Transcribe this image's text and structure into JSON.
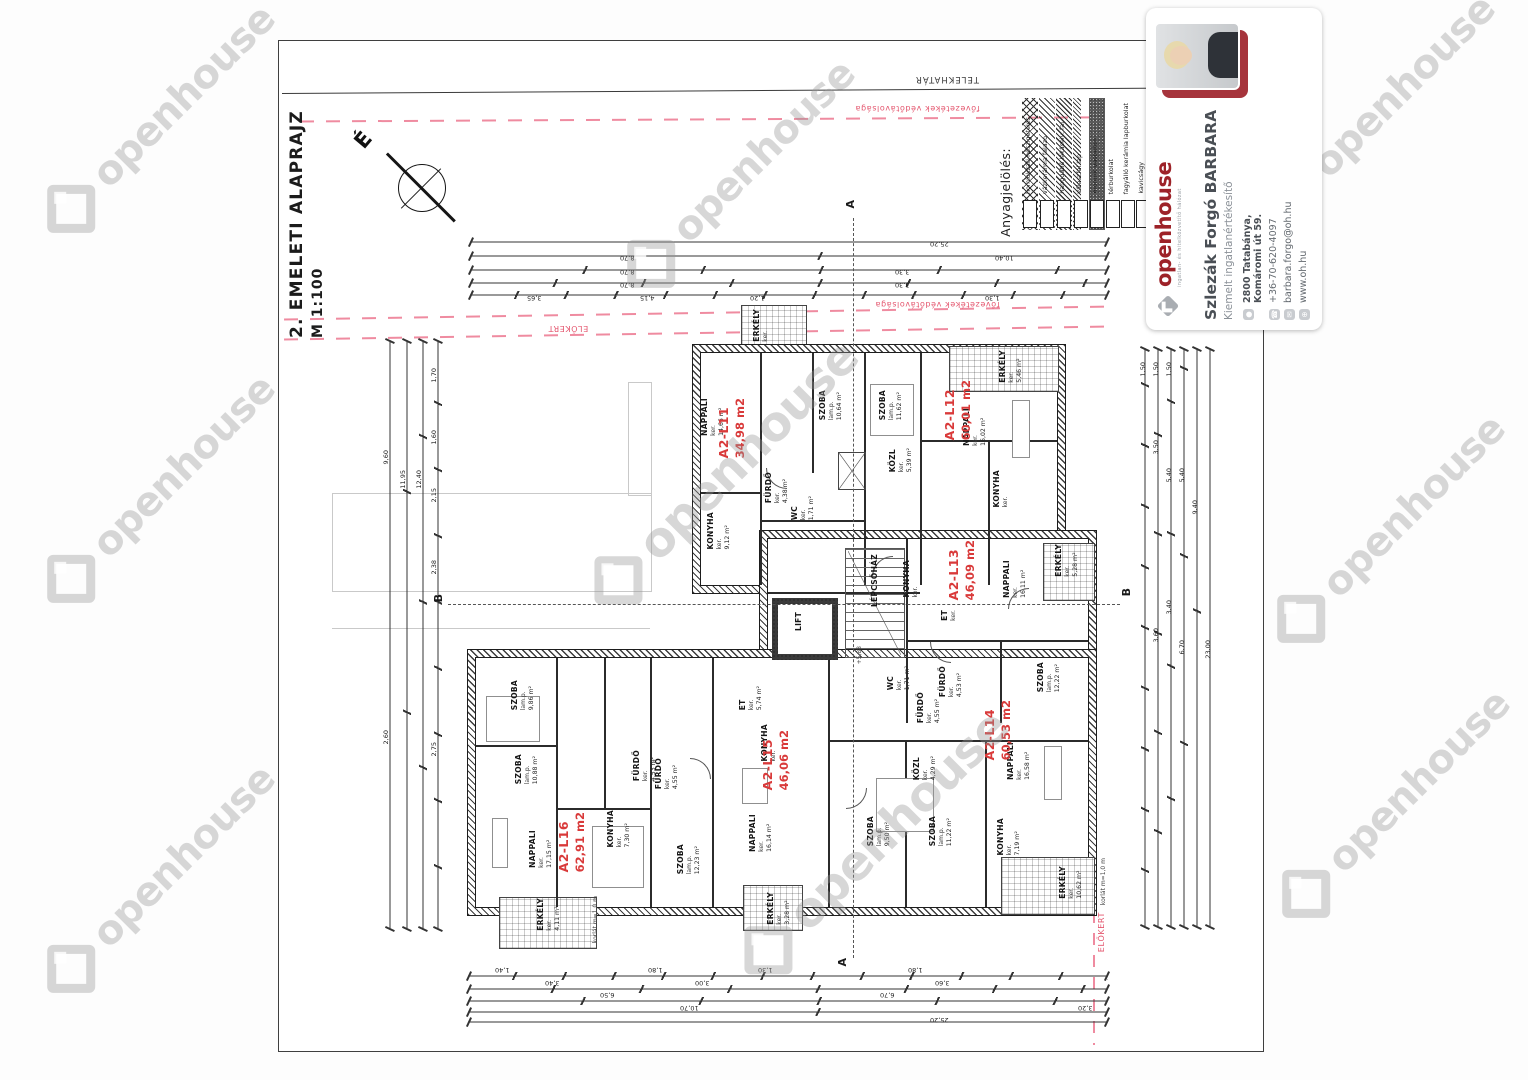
{
  "page": {
    "title": "2. EMELETI ALAPRAJZ",
    "scale": "M 1:100",
    "north": "É",
    "boundary": {
      "telekhatar": "TELEKHATÁR",
      "vedotav_top": "fővezetékek védőtávolsága",
      "vedotav_mid": "fővezetékek védőtávolsága",
      "elokert_top": "ELŐKERT",
      "elokert_right": "ELŐKERT"
    }
  },
  "legend": {
    "heading": "Anyagjelölés:",
    "items": [
      {
        "label": "homlokzati hőszigetelés",
        "cls": "sw-xhatch",
        "pos": "left:1022px"
      },
      {
        "label": "vázkerámia falazó",
        "cls": "sw-diag",
        "pos": "left:1039px"
      },
      {
        "label": "hanggátló lakáselv. fal",
        "cls": "sw-diag2",
        "pos": "left:1056px"
      },
      {
        "label": "válaszfal lap",
        "cls": "sw-thin",
        "pos": "left:1073px"
      },
      {
        "label": "monolit vasbeton",
        "cls": "sw-speckle",
        "pos": "left:1089px"
      },
      {
        "label": "térburkolat",
        "cls": "sw-empty",
        "pos": "left:1105px"
      },
      {
        "label": "fagyálló kerámia lapburkolat",
        "cls": "sw-empty",
        "pos": "left:1120px"
      },
      {
        "label": "kavicságy",
        "cls": "sw-empty",
        "pos": "left:1135px"
      }
    ]
  },
  "plan": {
    "apartments": [
      {
        "id": "A2-L11",
        "area": "34,98 m2",
        "pos": "left:716px;top:398px"
      },
      {
        "id": "A2-L12",
        "area": "60,01 m2",
        "pos": "left:942px;top:380px"
      },
      {
        "id": "A2-L13",
        "area": "46,09 m2",
        "pos": "left:946px;top:540px"
      },
      {
        "id": "A2-L14",
        "area": "60,53 m2",
        "pos": "left:982px;top:700px"
      },
      {
        "id": "A2-L15",
        "area": "46,06 m2",
        "pos": "left:760px;top:730px"
      },
      {
        "id": "A2-L16",
        "area": "62,91 m2",
        "pos": "left:556px;top:812px"
      }
    ],
    "rooms": [
      {
        "n": "NAPPALI",
        "s": "ker.",
        "a": "14,66 m²",
        "pos": "left:700px;top:398px"
      },
      {
        "n": "SZOBA",
        "s": "lam.p.",
        "a": "10,64 m²",
        "pos": "left:818px;top:390px"
      },
      {
        "n": "SZOBA",
        "s": "lam.p.",
        "a": "11,62 m²",
        "pos": "left:878px;top:390px"
      },
      {
        "n": "KONYHA",
        "s": "ker.",
        "a": "9,12 m²",
        "pos": "left:706px;top:512px"
      },
      {
        "n": "FÜRDŐ",
        "s": "ker.",
        "a": "4,38 m²",
        "pos": "left:764px;top:472px"
      },
      {
        "n": "WC",
        "s": "ker.",
        "a": "1,71 m²",
        "pos": "left:790px;top:496px"
      },
      {
        "n": "KÖZL",
        "s": "ker.",
        "a": "5,39 m²",
        "pos": "left:888px;top:448px"
      },
      {
        "n": "NAPPALI",
        "s": "ker.",
        "a": "16,02 m²",
        "pos": "left:962px;top:408px"
      },
      {
        "n": "KONYHA",
        "s": "ker.",
        "a": "",
        "pos": "left:992px;top:470px"
      },
      {
        "n": "ERKÉLY",
        "s": "ker.",
        "a": "5,46 m²",
        "pos": "left:998px;top:350px"
      },
      {
        "n": "ERKÉLY",
        "s": "ker.",
        "a": "",
        "pos": "left:752px;top:309px"
      },
      {
        "n": "KONYHA",
        "s": "ker.",
        "a": "",
        "pos": "left:902px;top:560px"
      },
      {
        "n": "NAPPALI",
        "s": "ker.",
        "a": "16,11 m²",
        "pos": "left:1002px;top:560px"
      },
      {
        "n": "SZOBA",
        "s": "lam.p.",
        "a": "12,22 m²",
        "pos": "left:1036px;top:662px"
      },
      {
        "n": "FÜRDŐ",
        "s": "ker.",
        "a": "4,53 m²",
        "pos": "left:938px;top:666px"
      },
      {
        "n": "ERKÉLY",
        "s": "ker.",
        "a": "5,28 m²",
        "pos": "left:1054px;top:544px"
      },
      {
        "n": "ET",
        "s": "ker.",
        "a": "",
        "pos": "left:940px;top:610px"
      },
      {
        "n": "NAPPALI",
        "s": "ker.",
        "a": "16,58 m²",
        "pos": "left:1006px;top:742px"
      },
      {
        "n": "SZOBA",
        "s": "lam.p.",
        "a": "11,22 m²",
        "pos": "left:928px;top:816px"
      },
      {
        "n": "SZOBA",
        "s": "lam.p.",
        "a": "9,50 m²",
        "pos": "left:866px;top:816px"
      },
      {
        "n": "KONYHA",
        "s": "ker.",
        "a": "7,19 m²",
        "pos": "left:996px;top:818px"
      },
      {
        "n": "FÜRDŐ",
        "s": "ker.",
        "a": "4,55 m²",
        "pos": "left:916px;top:692px"
      },
      {
        "n": "WC",
        "s": "ker.",
        "a": "1,71 m²",
        "pos": "left:886px;top:666px"
      },
      {
        "n": "KÖZL",
        "s": "ker.",
        "a": "4,29 m²",
        "pos": "left:912px;top:756px"
      },
      {
        "n": "ERKÉLY",
        "s": "ker.",
        "a": "10,62 m²",
        "pos": "left:1058px;top:866px"
      },
      {
        "n": "NAPPALI",
        "s": "ker.",
        "a": "16,14 m²",
        "pos": "left:748px;top:814px"
      },
      {
        "n": "SZOBA",
        "s": "lam.p.",
        "a": "12,23 m²",
        "pos": "left:676px;top:844px"
      },
      {
        "n": "KONYHA",
        "s": "ker.",
        "a": "",
        "pos": "left:760px;top:724px"
      },
      {
        "n": "FÜRDŐ",
        "s": "ker.",
        "a": "4,55 m²",
        "pos": "left:654px;top:758px"
      },
      {
        "n": "ET",
        "s": "ker.",
        "a": "5,74 m²",
        "pos": "left:738px;top:686px"
      },
      {
        "n": "ERKÉLY",
        "s": "ker.",
        "a": "3,28 m²",
        "pos": "left:766px;top:892px"
      },
      {
        "n": "NAPPALI",
        "s": "ker.",
        "a": "17,15 m²",
        "pos": "left:528px;top:830px"
      },
      {
        "n": "SZOBA",
        "s": "lam.p.",
        "a": "9,86 m²",
        "pos": "left:510px;top:680px"
      },
      {
        "n": "SZOBA",
        "s": "lam.p.",
        "a": "10,88 m²",
        "pos": "left:514px;top:754px"
      },
      {
        "n": "KONYHA",
        "s": "ker.",
        "a": "7,30 m²",
        "pos": "left:606px;top:810px"
      },
      {
        "n": "FÜRDŐ",
        "s": "ker.",
        "a": "4,53 m²",
        "pos": "left:632px;top:750px"
      },
      {
        "n": "ERKÉLY",
        "s": "ker.",
        "a": "4,11 m²",
        "pos": "left:536px;top:898px"
      },
      {
        "n": "LIFT",
        "s": "",
        "a": "",
        "pos": "left:794px;top:612px"
      },
      {
        "n": "LÉPCSŐHÁZ",
        "s": "",
        "a": "",
        "pos": "left:870px;top:554px"
      }
    ],
    "sections": [
      {
        "t": "A",
        "pos": "left:844px;top:200px"
      },
      {
        "t": "A",
        "pos": "left:836px;top:958px"
      },
      {
        "t": "B",
        "pos": "left:432px;top:594px"
      },
      {
        "t": "B",
        "pos": "left:1120px;top:588px"
      }
    ],
    "notes": [
      {
        "t": "korlát m=1,0 m",
        "pos": "left:592px;top:896px"
      },
      {
        "t": "korlát m=1,0 m",
        "pos": "left:1100px;top:858px"
      },
      {
        "t": "+5,88",
        "pos": "left:856px;top:646px"
      }
    ]
  },
  "dimensions": {
    "numbers": [
      {
        "t": "25,20",
        "cls": "r180",
        "pos": "left:930px;top:240px"
      },
      {
        "t": "10,40",
        "cls": "r180",
        "pos": "left:995px;top:254px"
      },
      {
        "t": "8,70",
        "cls": "r180",
        "pos": "left:620px;top:254px"
      },
      {
        "t": "8,70",
        "cls": "r180",
        "pos": "left:620px;top:268px"
      },
      {
        "t": "3,30",
        "cls": "r180",
        "pos": "left:895px;top:268px"
      },
      {
        "t": "8,70",
        "cls": "r180",
        "pos": "left:620px;top:281px"
      },
      {
        "t": "3,30",
        "cls": "r180",
        "pos": "left:895px;top:281px"
      },
      {
        "t": "4,15",
        "cls": "r180",
        "pos": "left:640px;top:294px"
      },
      {
        "t": "3,65",
        "cls": "r180",
        "pos": "left:527px;top:294px"
      },
      {
        "t": "1,20",
        "cls": "r180",
        "pos": "left:750px;top:294px"
      },
      {
        "t": "1,30",
        "cls": "r180",
        "pos": "left:985px;top:294px"
      },
      {
        "t": "25,20",
        "cls": "r180",
        "pos": "left:930px;top:1016px"
      },
      {
        "t": "10,70",
        "cls": "r180",
        "pos": "left:680px;top:1004px"
      },
      {
        "t": "6,50",
        "cls": "r180",
        "pos": "left:600px;top:991px"
      },
      {
        "t": "6,70",
        "cls": "r180",
        "pos": "left:880px;top:991px"
      },
      {
        "t": "3,40",
        "cls": "r180",
        "pos": "left:545px;top:979px"
      },
      {
        "t": "3,00",
        "cls": "r180",
        "pos": "left:695px;top:979px"
      },
      {
        "t": "3,60",
        "cls": "r180",
        "pos": "left:935px;top:979px"
      },
      {
        "t": "1,40",
        "cls": "r180",
        "pos": "left:495px;top:966px"
      },
      {
        "t": "1,80",
        "cls": "r180",
        "pos": "left:648px;top:966px"
      },
      {
        "t": "1,30",
        "cls": "r180",
        "pos": "left:758px;top:966px"
      },
      {
        "t": "1,80",
        "cls": "r180",
        "pos": "left:908px;top:966px"
      },
      {
        "t": "3,20",
        "cls": "r180",
        "pos": "left:1078px;top:1004px"
      },
      {
        "t": "9,60",
        "cls": "vert",
        "pos": "left:382px;top:450px"
      },
      {
        "t": "11,95",
        "cls": "vert",
        "pos": "left:399px;top:470px"
      },
      {
        "t": "12,40",
        "cls": "vert",
        "pos": "left:415px;top:470px"
      },
      {
        "t": "1,70",
        "cls": "vert",
        "pos": "left:430px;top:368px"
      },
      {
        "t": "1,60",
        "cls": "vert",
        "pos": "left:430px;top:430px"
      },
      {
        "t": "2,15",
        "cls": "vert",
        "pos": "left:430px;top:488px"
      },
      {
        "t": "2,38",
        "cls": "vert",
        "pos": "left:430px;top:560px"
      },
      {
        "t": "2,75",
        "cls": "vert",
        "pos": "left:430px;top:742px"
      },
      {
        "t": "2,60",
        "cls": "vert",
        "pos": "left:382px;top:730px"
      },
      {
        "t": "1,50",
        "cls": "vert",
        "pos": "left:1139px;top:362px"
      },
      {
        "t": "1,50",
        "cls": "vert",
        "pos": "left:1152px;top:362px"
      },
      {
        "t": "1,50",
        "cls": "vert",
        "pos": "left:1165px;top:362px"
      },
      {
        "t": "3,50",
        "cls": "vert",
        "pos": "left:1152px;top:440px"
      },
      {
        "t": "5,40",
        "cls": "vert",
        "pos": "left:1165px;top:468px"
      },
      {
        "t": "5,40",
        "cls": "vert",
        "pos": "left:1178px;top:468px"
      },
      {
        "t": "9,40",
        "cls": "vert",
        "pos": "left:1191px;top:500px"
      },
      {
        "t": "3,60",
        "cls": "vert",
        "pos": "left:1152px;top:628px"
      },
      {
        "t": "3,40",
        "cls": "vert",
        "pos": "left:1165px;top:600px"
      },
      {
        "t": "6,70",
        "cls": "vert",
        "pos": "left:1178px;top:640px"
      },
      {
        "t": "23,00",
        "cls": "vert",
        "pos": "left:1204px;top:640px"
      }
    ]
  },
  "watermark": {
    "text": "openhouse",
    "instances": [
      {
        "pos": "left:10px;top:95px"
      },
      {
        "pos": "left:590px;top:150px"
      },
      {
        "pos": "left:1230px;top:85px"
      },
      {
        "pos": "left:10px;top:465px"
      },
      {
        "pos": "left:550px;top:445px;font-size:48px"
      },
      {
        "pos": "left:1240px;top:505px"
      },
      {
        "pos": "left:10px;top:855px"
      },
      {
        "pos": "left:700px;top:815px;font-size:48px"
      },
      {
        "pos": "left:1245px;top:780px"
      }
    ]
  },
  "card": {
    "brand": "openhouse",
    "tagline": "ingatlan- és hitelközvetítő hálózat",
    "name": "Szlezák Forgó BARBARA",
    "role": "Kiemelt ingatlanértékesítő",
    "address1": "2800 Tatabánya,",
    "address2": "Komáromi út 59.",
    "phone": "+36-70-620-4097",
    "email": "barbara.forgo@oh.hu",
    "web": "www.oh.hu",
    "icons": {
      "location": "●",
      "phone": "☎",
      "email": "✉",
      "web": "⊕"
    }
  }
}
